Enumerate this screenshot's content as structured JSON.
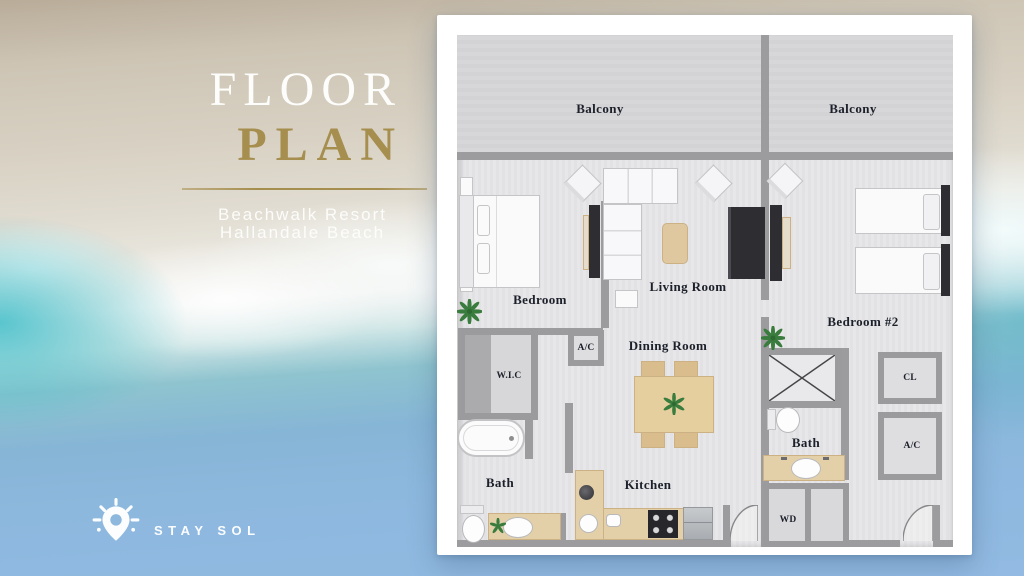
{
  "poster": {
    "title": {
      "line1": "FLOOR",
      "line2": "PLAN"
    },
    "subtitle": {
      "line1": "Beachwalk Resort",
      "line2": "Hallandale Beach"
    },
    "brand": {
      "name": "STAY SOL"
    }
  },
  "plan": {
    "labels": {
      "balcony1": "Balcony",
      "balcony2": "Balcony",
      "bedroom": "Bedroom",
      "living_room": "Living Room",
      "dining_room": "Dining Room",
      "kitchen": "Kitchen",
      "bath1": "Bath",
      "bath2": "Bath",
      "bedroom2": "Bedroom #2",
      "wic": "W.I.C",
      "ac1": "A/C",
      "ac2": "A/C",
      "cl": "CL",
      "wd": "WD"
    }
  },
  "colors": {
    "title_gold": "#a68e4e",
    "sand": "#cfc7b8",
    "turquoise": "#62c1cb",
    "ocean_blue": "#92bae2",
    "card_white": "#ffffff",
    "wall_gray": "#9b9b9d",
    "wood_tan": "#e3d0a8",
    "label_ink": "#1c202a"
  }
}
